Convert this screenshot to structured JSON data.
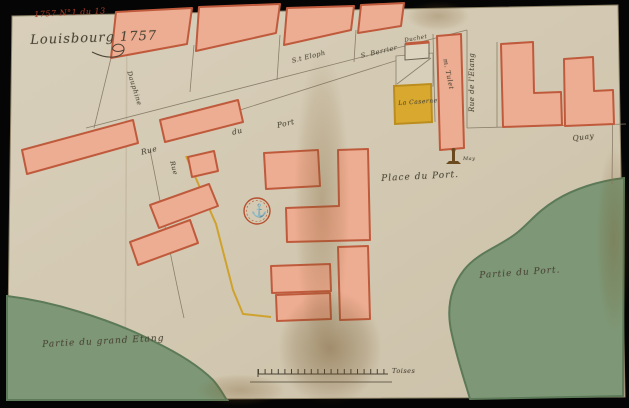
{
  "document": {
    "archival_note": "1757 N°1 du 13",
    "title": "Louisbourg 1757"
  },
  "streets": {
    "rue": "Rue",
    "du": "du",
    "port": "Port",
    "dauphine": "Dauphine",
    "rue_vertical": "Rue",
    "etang": "Rue de l'Etang",
    "quay": "Quay"
  },
  "lots": {
    "st_eloph": "S.t Eloph",
    "berrier": "S. Berrier",
    "duchet": "Duchet",
    "caserne": "La Caserne",
    "tulet": "m. Tulet",
    "may": "May"
  },
  "places": {
    "place_du_port": "Place du Port."
  },
  "water": {
    "port": "Partie du Port.",
    "etang": "Partie du grand Etang"
  },
  "scale": {
    "unit_label": "Toises"
  },
  "icons": {
    "anchor_seal": "⚓"
  },
  "colors": {
    "paper": "#d5cbb6",
    "building_fill": "#edad92",
    "building_stroke": "#c05a3c",
    "yellow_fill": "#d9a92f",
    "yellow_stroke": "#bb8d1f",
    "water_fill": "#7e9877",
    "water_stroke": "#5c7a58",
    "ink": "#4a4435",
    "red_ink": "#a83a26",
    "backdrop": "#000000"
  }
}
